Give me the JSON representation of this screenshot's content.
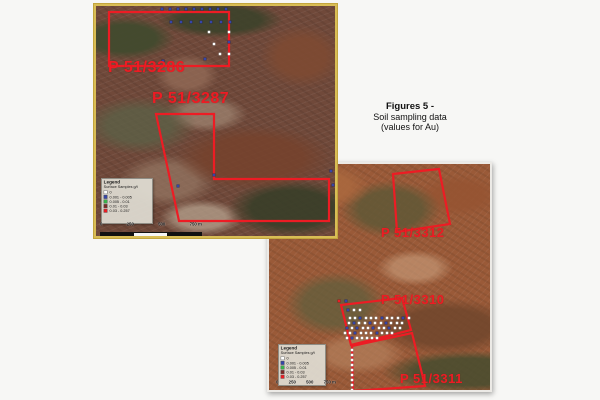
{
  "caption": {
    "title": "Figures 5 -",
    "line1": "Soil sampling data",
    "line2": "(values for Au)"
  },
  "legend": {
    "title": "Legend",
    "subtitle": "Surface Samples g/t",
    "items": [
      {
        "label": "0",
        "color": "#ffffff"
      },
      {
        "label": "0.001 - 0.005",
        "color": "#3545a8"
      },
      {
        "label": "0.005 - 0.01",
        "color": "#39b54a"
      },
      {
        "label": "0.01 - 0.03",
        "color": "#7b2a26"
      },
      {
        "label": "0.03 - 0.257",
        "color": "#ed1c24"
      }
    ]
  },
  "scalebar": {
    "labels": [
      "0",
      "250",
      "500",
      "750 m"
    ]
  },
  "colors": {
    "outline": "#ed1c24",
    "label": "#ed1c24",
    "map1_border": "#d9bd55",
    "dot_white": "#ffffff",
    "dot_blue": "#3545a8",
    "dot_red": "#ed1c24"
  },
  "maps": [
    {
      "name": "north-map",
      "tenements": [
        {
          "label": "P 51/3286"
        },
        {
          "label": "P 51/3287"
        }
      ],
      "polygons": [
        {
          "tenement": "P 51/3286",
          "points": "13,6 133,6 133,60 13,60"
        },
        {
          "tenement": "P 51/3287",
          "points": "60,108 118,108 118,173 233,173 233,215 83,215"
        }
      ],
      "dots": [
        [
          66,
          3,
          "b"
        ],
        [
          74,
          3,
          "b"
        ],
        [
          82,
          3,
          "b"
        ],
        [
          90,
          3,
          "b"
        ],
        [
          98,
          3,
          "b"
        ],
        [
          106,
          3,
          "b"
        ],
        [
          114,
          3,
          "b"
        ],
        [
          122,
          3,
          "b"
        ],
        [
          130,
          3,
          "b"
        ],
        [
          75,
          16,
          "b"
        ],
        [
          85,
          16,
          "b"
        ],
        [
          95,
          16,
          "b"
        ],
        [
          105,
          16,
          "b"
        ],
        [
          115,
          16,
          "b"
        ],
        [
          125,
          16,
          "b"
        ],
        [
          134,
          16,
          "b"
        ],
        [
          113,
          26,
          "w"
        ],
        [
          133,
          26,
          "w"
        ],
        [
          133,
          36,
          "b"
        ],
        [
          118,
          38,
          "w"
        ],
        [
          124,
          48,
          "w"
        ],
        [
          133,
          48,
          "w"
        ],
        [
          109,
          53,
          "b"
        ],
        [
          67,
          55,
          "b"
        ],
        [
          118,
          169,
          "b"
        ],
        [
          235,
          165,
          "b"
        ],
        [
          237,
          179,
          "b"
        ],
        [
          82,
          180,
          "b"
        ]
      ]
    },
    {
      "name": "south-map",
      "tenements": [
        {
          "label": "P 51/3312"
        },
        {
          "label": "P 51/3310"
        },
        {
          "label": "P 51/3311"
        }
      ],
      "polygons": [
        {
          "tenement": "P 51/3312",
          "points": "124,10 170,5 181,60 128,68"
        },
        {
          "tenement": "P 51/3310",
          "points": "72,141 133,134 142,166 82,181"
        },
        {
          "tenement": "P 51/3311",
          "points": "83,182 143,169 156,222 84,227"
        }
      ],
      "dots": [
        [
          70,
          137,
          "r"
        ],
        [
          77,
          137,
          "b"
        ],
        [
          79,
          146,
          "b"
        ],
        [
          85,
          146,
          "w"
        ],
        [
          91,
          146,
          "w"
        ],
        [
          81,
          154,
          "w"
        ],
        [
          86,
          154,
          "w"
        ],
        [
          91,
          154,
          "b"
        ],
        [
          97,
          154,
          "w"
        ],
        [
          102,
          154,
          "w"
        ],
        [
          107,
          154,
          "w"
        ],
        [
          113,
          154,
          "b"
        ],
        [
          118,
          154,
          "w"
        ],
        [
          123,
          154,
          "w"
        ],
        [
          129,
          154,
          "w"
        ],
        [
          134,
          154,
          "b"
        ],
        [
          140,
          154,
          "w"
        ],
        [
          80,
          159,
          "w"
        ],
        [
          85,
          159,
          "b"
        ],
        [
          90,
          159,
          "w"
        ],
        [
          96,
          159,
          "w"
        ],
        [
          101,
          159,
          "b"
        ],
        [
          106,
          159,
          "w"
        ],
        [
          112,
          159,
          "w"
        ],
        [
          117,
          159,
          "b"
        ],
        [
          122,
          159,
          "w"
        ],
        [
          128,
          159,
          "w"
        ],
        [
          133,
          159,
          "w"
        ],
        [
          78,
          164,
          "b"
        ],
        [
          83,
          164,
          "w"
        ],
        [
          88,
          164,
          "b"
        ],
        [
          94,
          164,
          "w"
        ],
        [
          99,
          164,
          "w"
        ],
        [
          104,
          164,
          "b"
        ],
        [
          110,
          164,
          "w"
        ],
        [
          115,
          164,
          "w"
        ],
        [
          120,
          164,
          "b"
        ],
        [
          126,
          164,
          "w"
        ],
        [
          131,
          164,
          "w"
        ],
        [
          76,
          169,
          "w"
        ],
        [
          81,
          169,
          "w"
        ],
        [
          86,
          169,
          "b"
        ],
        [
          92,
          169,
          "w"
        ],
        [
          97,
          169,
          "w"
        ],
        [
          102,
          169,
          "w"
        ],
        [
          108,
          169,
          "b"
        ],
        [
          113,
          169,
          "w"
        ],
        [
          118,
          169,
          "w"
        ],
        [
          123,
          169,
          "w"
        ],
        [
          78,
          174,
          "w"
        ],
        [
          83,
          174,
          "b"
        ],
        [
          88,
          174,
          "w"
        ],
        [
          93,
          174,
          "w"
        ],
        [
          98,
          174,
          "w"
        ],
        [
          103,
          174,
          "w"
        ],
        [
          108,
          174,
          "w"
        ],
        [
          83,
          186,
          "w"
        ],
        [
          83,
          191,
          "w"
        ],
        [
          83,
          196,
          "w"
        ],
        [
          83,
          201,
          "w"
        ],
        [
          83,
          206,
          "w"
        ],
        [
          83,
          211,
          "w"
        ],
        [
          83,
          216,
          "w"
        ],
        [
          83,
          221,
          "w"
        ],
        [
          83,
          226,
          "w"
        ]
      ]
    }
  ]
}
